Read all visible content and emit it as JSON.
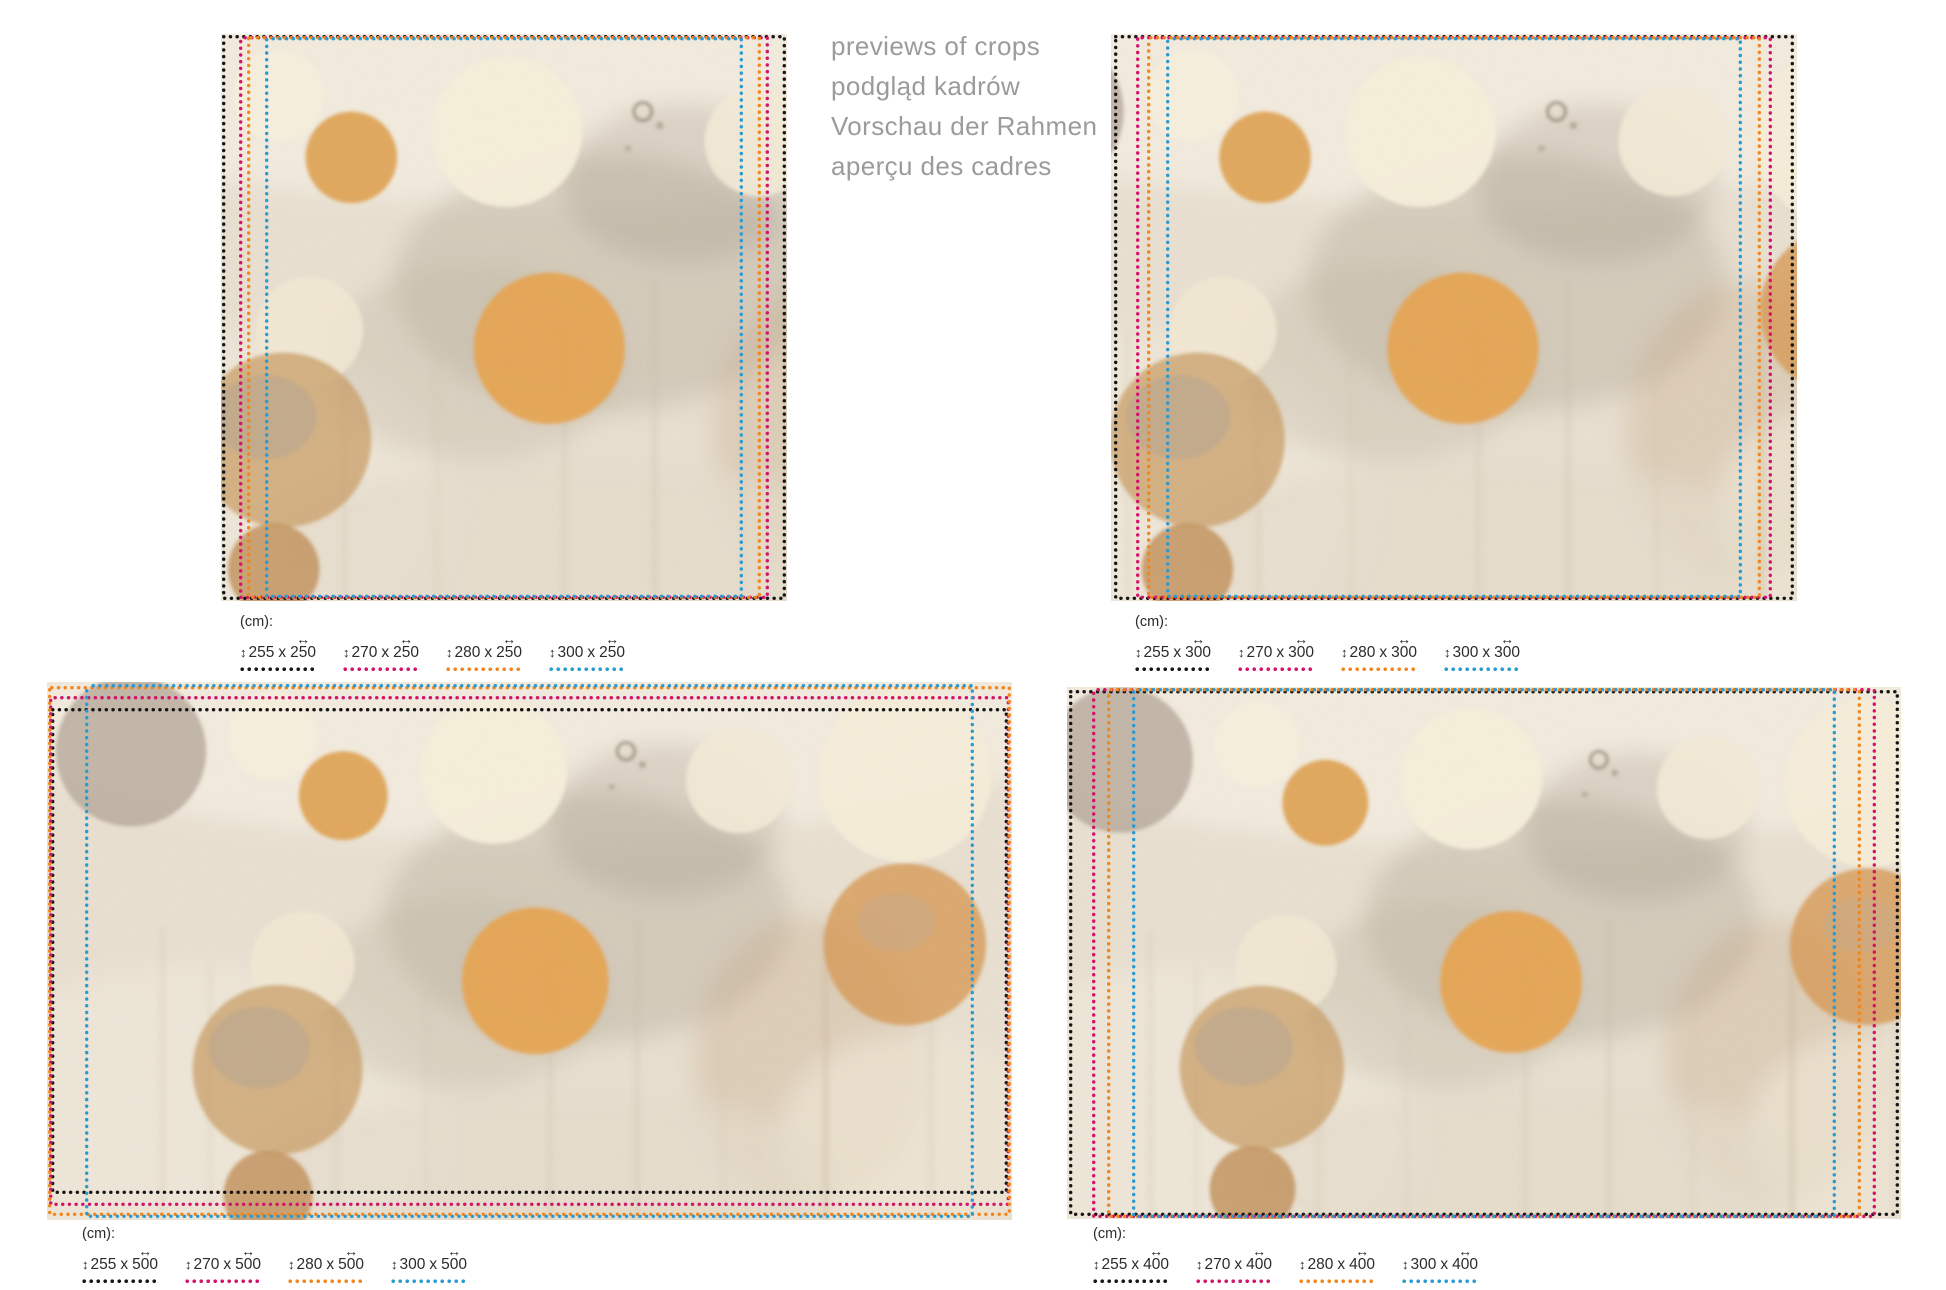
{
  "title_block": {
    "lines": [
      "previews of crops",
      "podgląd kadrów",
      "Vorschau der Rahmen",
      "aperçu des cadres"
    ],
    "text_color": "#9b9b9b"
  },
  "legend": {
    "unit_label": "(cm):",
    "separator": "x"
  },
  "icons": {
    "vertical_arrow": "↕",
    "horizontal_arrow": "↔"
  },
  "colors": {
    "black": "#161616",
    "magenta": "#d4136b",
    "orange": "#f0861c",
    "blue": "#2a9ad3",
    "legend_text": "#2b2b2b"
  },
  "panels": [
    {
      "name": "square-250",
      "crops": [
        {
          "color": "black",
          "height_cm": "255",
          "width_cm": "250"
        },
        {
          "color": "magenta",
          "height_cm": "270",
          "width_cm": "250"
        },
        {
          "color": "orange",
          "height_cm": "280",
          "width_cm": "250"
        },
        {
          "color": "blue",
          "height_cm": "300",
          "width_cm": "250"
        }
      ]
    },
    {
      "name": "square-300",
      "crops": [
        {
          "color": "black",
          "height_cm": "255",
          "width_cm": "300"
        },
        {
          "color": "magenta",
          "height_cm": "270",
          "width_cm": "300"
        },
        {
          "color": "orange",
          "height_cm": "280",
          "width_cm": "300"
        },
        {
          "color": "blue",
          "height_cm": "300",
          "width_cm": "300"
        }
      ]
    },
    {
      "name": "wide-500",
      "crops": [
        {
          "color": "black",
          "height_cm": "255",
          "width_cm": "500"
        },
        {
          "color": "magenta",
          "height_cm": "270",
          "width_cm": "500"
        },
        {
          "color": "orange",
          "height_cm": "280",
          "width_cm": "500"
        },
        {
          "color": "blue",
          "height_cm": "300",
          "width_cm": "500"
        }
      ]
    },
    {
      "name": "wide-400",
      "crops": [
        {
          "color": "black",
          "height_cm": "255",
          "width_cm": "400"
        },
        {
          "color": "magenta",
          "height_cm": "270",
          "width_cm": "400"
        },
        {
          "color": "orange",
          "height_cm": "280",
          "width_cm": "400"
        },
        {
          "color": "blue",
          "height_cm": "300",
          "width_cm": "400"
        }
      ]
    }
  ]
}
